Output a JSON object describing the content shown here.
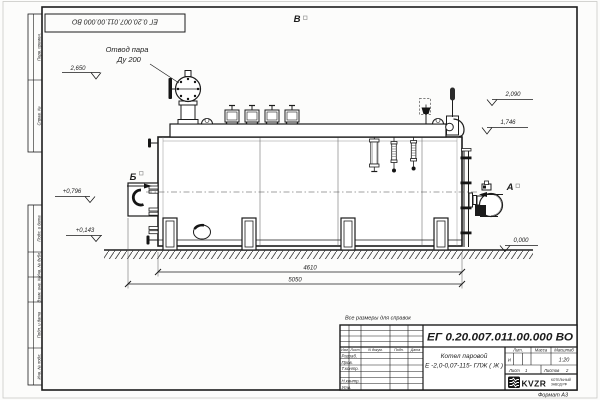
{
  "sheet": {
    "top_stamp_code": "ЕГ 0.20.007.011.00.000  ВО",
    "format_note": "Формат А3",
    "margin_top": [
      "Перв. примен.",
      "Справ. №"
    ],
    "margin_bottom": [
      "Подп. и дата",
      "Инв. № дубл.",
      "Взам. инв. №",
      "Подп. и дата",
      "Инв. № подл."
    ]
  },
  "drawing": {
    "callout_line1": "Отвод пара",
    "callout_line2": "Ду 200",
    "view_top": "В",
    "view_right": "А",
    "view_left": "Б",
    "elev_2650": "2,650",
    "elev_2090": "2,090",
    "elev_1746": "1,746",
    "elev_0796": "+0,796",
    "elev_0143": "+0,143",
    "elev_0000": "0,000",
    "dim_inner": "4610",
    "dim_outer": "5050"
  },
  "title_block": {
    "reference_note": "Все размеры для справок",
    "designation": "ЕГ 0.20.007.011.00.000  ВО",
    "product_name": "Котел паровой",
    "product_type": "Е -2,0-0,07-115- ГЛЖ ( Ж )",
    "col_lit": "Лит.",
    "col_mass": "Масса",
    "col_scale": "Масштаб",
    "lit_value": "И",
    "scale_value": "1:20",
    "sheet_label": "Лист",
    "sheet_value": "1",
    "sheets_label": "Листов",
    "sheets_value": "2",
    "sig_cols": [
      "Изм",
      "Лист",
      "N докум.",
      "Подп.",
      "Дата"
    ],
    "sig_rows": [
      "Разраб.",
      "Пров.",
      "Т.контр.",
      "",
      "Н.контр.",
      "Утв."
    ],
    "logo": "KVZR",
    "logo_sub1": "КОТЕЛЬНЫЙ",
    "logo_sub2": "ЗАВОД РФ"
  }
}
